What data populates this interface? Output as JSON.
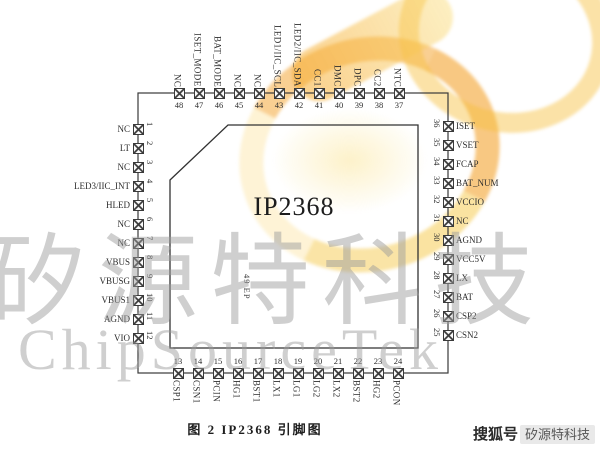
{
  "figure": {
    "caption": "图 2   IP2368 引脚图"
  },
  "chip": {
    "name": "IP2368",
    "exposed_pad_label": "49 EP",
    "pins": {
      "left": [
        {
          "num": "1",
          "label": "NC"
        },
        {
          "num": "2",
          "label": "LT"
        },
        {
          "num": "3",
          "label": "NC"
        },
        {
          "num": "4",
          "label": "LED3/IIC_INT"
        },
        {
          "num": "5",
          "label": "HLED"
        },
        {
          "num": "6",
          "label": "NC"
        },
        {
          "num": "7",
          "label": "NC"
        },
        {
          "num": "8",
          "label": "VBUS"
        },
        {
          "num": "9",
          "label": "VBUSG"
        },
        {
          "num": "10",
          "label": "VBUS1"
        },
        {
          "num": "11",
          "label": "AGND"
        },
        {
          "num": "12",
          "label": "VIO"
        }
      ],
      "top": [
        {
          "num": "48",
          "label": "NC"
        },
        {
          "num": "47",
          "label": "ISET_MODE"
        },
        {
          "num": "46",
          "label": "BAT_MODE"
        },
        {
          "num": "45",
          "label": "NC"
        },
        {
          "num": "44",
          "label": "NC"
        },
        {
          "num": "43",
          "label": "LED1/IIC_SCL"
        },
        {
          "num": "42",
          "label": "LED2/IIC_SDA"
        },
        {
          "num": "41",
          "label": "CC1"
        },
        {
          "num": "40",
          "label": "DMC"
        },
        {
          "num": "39",
          "label": "DPC"
        },
        {
          "num": "38",
          "label": "CC2"
        },
        {
          "num": "37",
          "label": "NTC"
        }
      ],
      "right": [
        {
          "num": "36",
          "label": "ISET"
        },
        {
          "num": "35",
          "label": "VSET"
        },
        {
          "num": "34",
          "label": "FCAP"
        },
        {
          "num": "33",
          "label": "BAT_NUM"
        },
        {
          "num": "32",
          "label": "VCCIO"
        },
        {
          "num": "31",
          "label": "NC"
        },
        {
          "num": "30",
          "label": "AGND"
        },
        {
          "num": "29",
          "label": "VCC5V"
        },
        {
          "num": "28",
          "label": "LX"
        },
        {
          "num": "27",
          "label": "BAT"
        },
        {
          "num": "26",
          "label": "CSP2"
        },
        {
          "num": "25",
          "label": "CSN2"
        }
      ],
      "bottom": [
        {
          "num": "13",
          "label": "CSP1"
        },
        {
          "num": "14",
          "label": "CSN1"
        },
        {
          "num": "15",
          "label": "PCIN"
        },
        {
          "num": "16",
          "label": "HG1"
        },
        {
          "num": "17",
          "label": "BST1"
        },
        {
          "num": "18",
          "label": "LX1"
        },
        {
          "num": "19",
          "label": "LG1"
        },
        {
          "num": "20",
          "label": "LG2"
        },
        {
          "num": "21",
          "label": "LX2"
        },
        {
          "num": "22",
          "label": "BST2"
        },
        {
          "num": "23",
          "label": "HG2"
        },
        {
          "num": "24",
          "label": "PCON"
        }
      ]
    }
  },
  "watermark": {
    "cn": "矽源特科技",
    "en": "ChipSourceTek"
  },
  "sohu": {
    "platform": "搜狐号",
    "account": "矽源特科技"
  },
  "colors": {
    "line": "#3a3a3a",
    "logo_orange": "#f3a028",
    "logo_yellow": "#f8d55e"
  }
}
